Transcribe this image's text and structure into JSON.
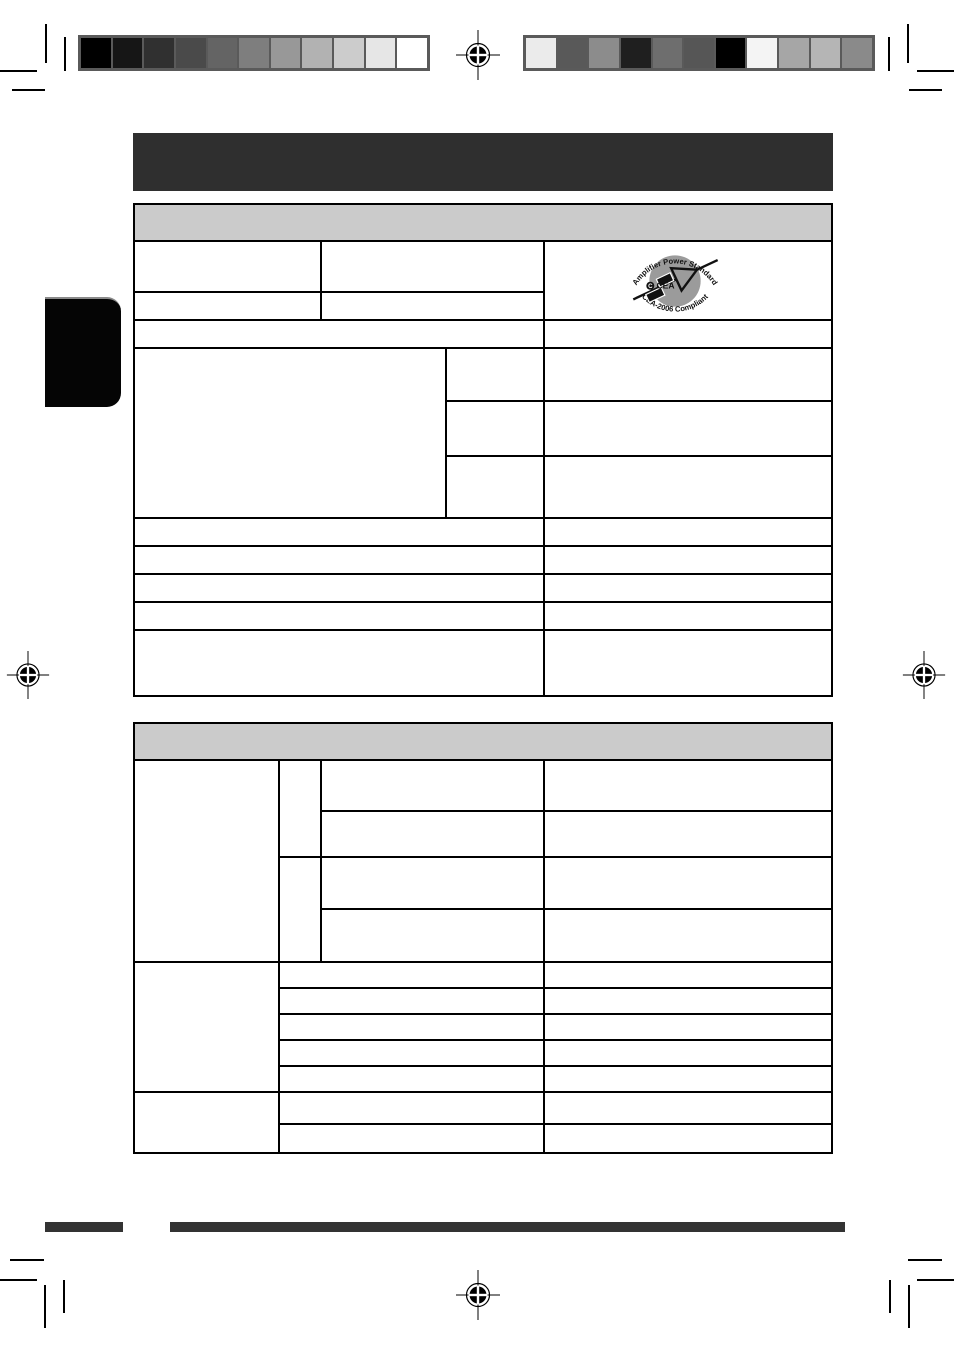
{
  "document": {
    "kind": "print-proof manual page",
    "page_background": "#ffffff"
  },
  "colors": {
    "title_bar": "#2f2f2f",
    "table_header_fill": "#cbcbcb",
    "grid_line": "#000000",
    "calibration_frame": "#5a5a5a",
    "footer_rule": "#333333",
    "side_tab": "#050505",
    "logo_circle": "#9b9b9b"
  },
  "calibration": {
    "left_bar_swatches": [
      "#000000",
      "#161616",
      "#303030",
      "#4a4a4a",
      "#646464",
      "#7e7e7e",
      "#989898",
      "#b2b2b2",
      "#cccccc",
      "#e6e6e6",
      "#ffffff"
    ],
    "right_bar_swatches": [
      "#ebebeb",
      "#595959",
      "#8c8c8c",
      "#1f1f1f",
      "#6e6e6e",
      "#565656",
      "#000000",
      "#f4f4f4",
      "#a6a6a6",
      "#b5b5b5",
      "#8a8a8a"
    ]
  },
  "title_bar": {
    "title": ""
  },
  "table1": {
    "header_title": ""
  },
  "table2": {
    "header_title": ""
  },
  "cea_logo": {
    "arc_top": "Amplifier Power Standard",
    "arc_bottom": "CEA-2006 Compliant",
    "mark": "CEA",
    "mark_symbol": "C"
  }
}
